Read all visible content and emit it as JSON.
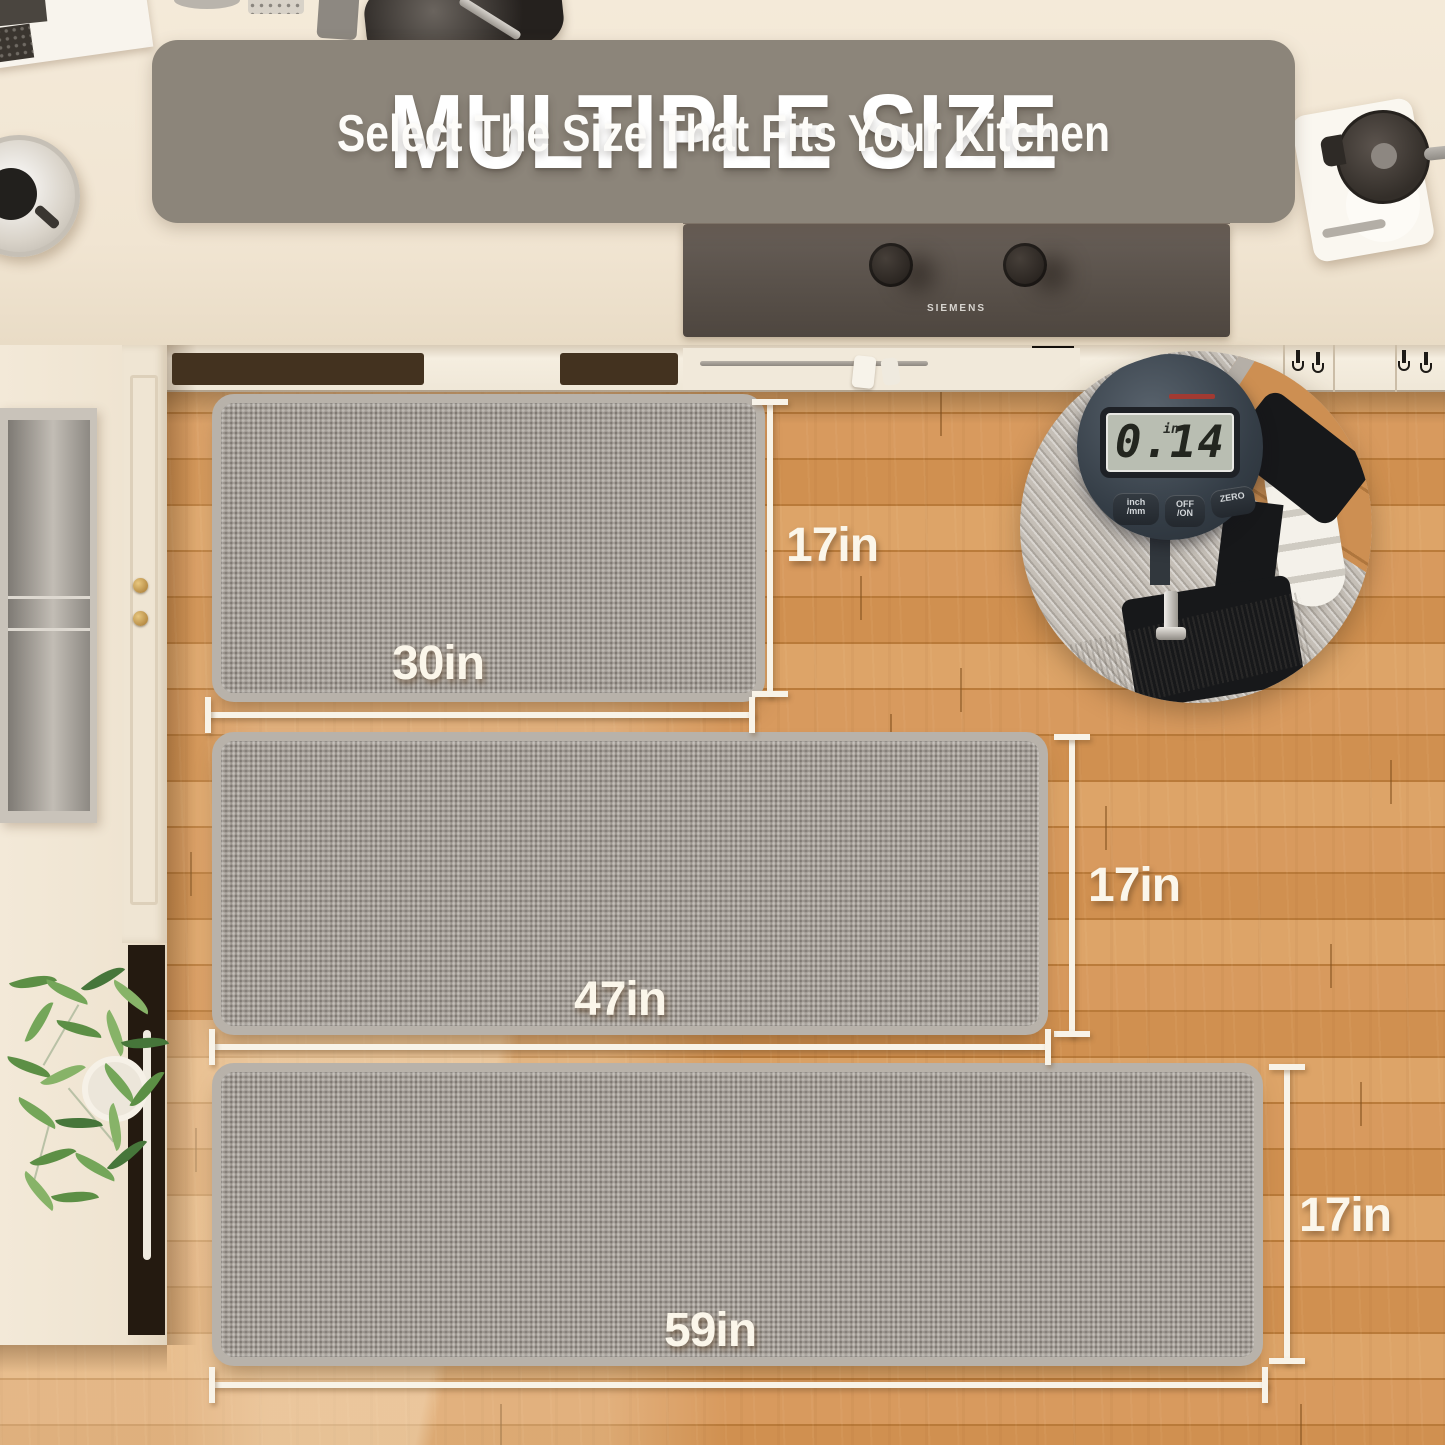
{
  "banner": {
    "title": "MULTIPLE SIZE",
    "subtitle": "Select The Size That Fits Your Kitchen",
    "background_color": "#8c857a",
    "text_color": "#ffffff"
  },
  "cooktop": {
    "brand": "SIEMENS"
  },
  "thickness_inset": {
    "display_value": "0.14",
    "display_unit": "in",
    "buttons": [
      {
        "line1": "inch",
        "line2": "/mm"
      },
      {
        "line1": "OFF",
        "line2": "/ON"
      },
      {
        "line1": "ZERO",
        "line2": ""
      }
    ]
  },
  "mats": [
    {
      "name": "small",
      "width_label": "30in",
      "height_label": "17in"
    },
    {
      "name": "medium",
      "width_label": "47in",
      "height_label": "17in"
    },
    {
      "name": "runner",
      "width_label": "59in",
      "height_label": "17in"
    }
  ],
  "colors": {
    "banner_gray": "#8c857a",
    "mat_gray": "#a49e97",
    "floor_wood": "#d09050",
    "dimension_text": "#fbf6ea",
    "lcd_screen": "#b9beb2"
  }
}
